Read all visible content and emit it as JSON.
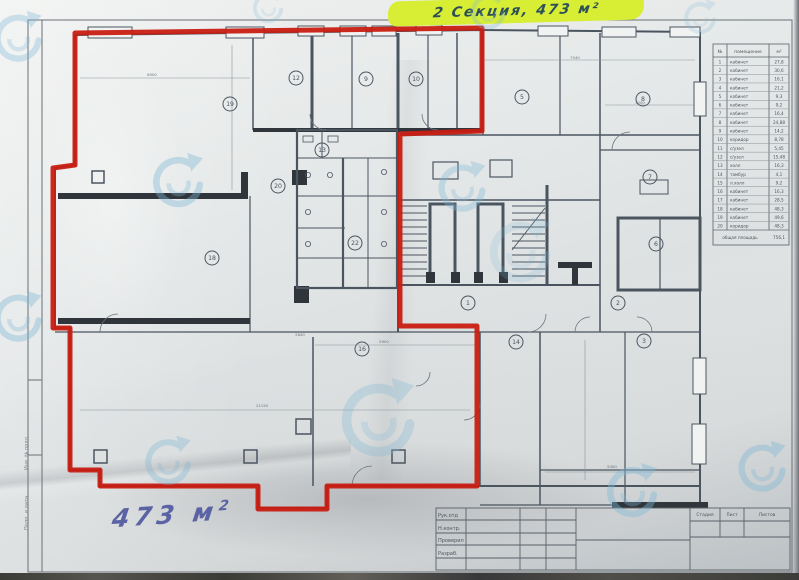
{
  "notes": {
    "top": {
      "text": "2 Секция, 473 м²"
    },
    "bottom": {
      "text": "473 м",
      "sup": "2"
    }
  },
  "colors": {
    "marker_red": "#c81d12",
    "highlight_green": "#d7ee35",
    "top_ink": "#2d4f58",
    "bottom_ink": "#5b63a4",
    "plan_line": "#4b5560",
    "watermark_blue": "#7fb8d6"
  },
  "schedule": {
    "headers": [
      "№",
      "помещение",
      "м²"
    ],
    "rows": [
      {
        "n": "1",
        "name": "кабинет",
        "area": "27,8"
      },
      {
        "n": "2",
        "name": "кабинет",
        "area": "30,6"
      },
      {
        "n": "3",
        "name": "кабинет",
        "area": "16,1"
      },
      {
        "n": "4",
        "name": "кабинет",
        "area": "21,2"
      },
      {
        "n": "5",
        "name": "кабинет",
        "area": "9,3"
      },
      {
        "n": "6",
        "name": "кабинет",
        "area": "9,2"
      },
      {
        "n": "7",
        "name": "кабинет",
        "area": "16,4"
      },
      {
        "n": "8",
        "name": "кабинет",
        "area": "24,88"
      },
      {
        "n": "9",
        "name": "кабинет",
        "area": "14,2"
      },
      {
        "n": "10",
        "name": "коридор",
        "area": "8,78"
      },
      {
        "n": "11",
        "name": "с/узел",
        "area": "5,45"
      },
      {
        "n": "12",
        "name": "с/узел",
        "area": "15,48"
      },
      {
        "n": "13",
        "name": "холл",
        "area": "16,3"
      },
      {
        "n": "14",
        "name": "тамбур",
        "area": "4,1"
      },
      {
        "n": "15",
        "name": "л.холл",
        "area": "9,2"
      },
      {
        "n": "16",
        "name": "кабинет",
        "area": "16,3"
      },
      {
        "n": "17",
        "name": "кабинет",
        "area": "28,5"
      },
      {
        "n": "18",
        "name": "кабинет",
        "area": "48,3"
      },
      {
        "n": "19",
        "name": "кабинет",
        "area": "49,6"
      },
      {
        "n": "20",
        "name": "коридор",
        "area": "48,3"
      }
    ],
    "total_label": "общая площадь",
    "total_value": "756,1"
  },
  "title_block": {
    "row_labels": [
      "Рук.отд",
      "Н.контр.",
      "Проверил",
      "Разраб."
    ],
    "stage_headers": [
      "Стадия",
      "Лист",
      "Листов"
    ]
  },
  "margin_labels": [
    "Подп. и дата",
    "Инв. № подл."
  ],
  "plan": {
    "room_numbers": [
      {
        "n": "19",
        "x": 230,
        "y": 104
      },
      {
        "n": "12",
        "x": 296,
        "y": 78
      },
      {
        "n": "9",
        "x": 366,
        "y": 79
      },
      {
        "n": "10",
        "x": 416,
        "y": 79
      },
      {
        "n": "5",
        "x": 522,
        "y": 97
      },
      {
        "n": "8",
        "x": 643,
        "y": 99
      },
      {
        "n": "20",
        "x": 278,
        "y": 186
      },
      {
        "n": "13",
        "x": 322,
        "y": 150
      },
      {
        "n": "18",
        "x": 212,
        "y": 258
      },
      {
        "n": "22",
        "x": 355,
        "y": 243
      },
      {
        "n": "7",
        "x": 650,
        "y": 177
      },
      {
        "n": "6",
        "x": 656,
        "y": 244
      },
      {
        "n": "1",
        "x": 468,
        "y": 303
      },
      {
        "n": "2",
        "x": 618,
        "y": 303
      },
      {
        "n": "16",
        "x": 362,
        "y": 349
      },
      {
        "n": "14",
        "x": 516,
        "y": 342
      },
      {
        "n": "3",
        "x": 644,
        "y": 341
      }
    ],
    "dims": [
      {
        "t": "6000",
        "x": 152,
        "y": 76
      },
      {
        "t": "7540",
        "x": 575,
        "y": 59
      },
      {
        "t": "3200",
        "x": 640,
        "y": 104
      },
      {
        "t": "21150",
        "x": 262,
        "y": 407
      },
      {
        "t": "5900",
        "x": 384,
        "y": 343
      },
      {
        "t": "5400",
        "x": 612,
        "y": 468
      },
      {
        "t": "2640",
        "x": 300,
        "y": 336
      }
    ]
  },
  "red_region": {
    "points": "75,33 482,28 482,131 400,134 400,326 477,326 477,486 327,486 327,509 258,509 258,486 100,486 100,470 70,470 70,328 53,328 53,168 75,165 75,33"
  },
  "watermarks": [
    {
      "x": -13,
      "y": 7,
      "s": 62,
      "o": 0.35
    },
    {
      "x": 145,
      "y": 149,
      "s": 66,
      "o": 0.4
    },
    {
      "x": -13,
      "y": 287,
      "s": 62,
      "o": 0.4
    },
    {
      "x": 138,
      "y": 432,
      "s": 60,
      "o": 0.35
    },
    {
      "x": 330,
      "y": 372,
      "s": 96,
      "o": 0.3
    },
    {
      "x": 431,
      "y": 157,
      "s": 62,
      "o": 0.35
    },
    {
      "x": 480,
      "y": 212,
      "s": 80,
      "o": 0.2
    },
    {
      "x": 465,
      "y": -11,
      "s": 46,
      "o": 0.28
    },
    {
      "x": 248,
      "y": -12,
      "s": 40,
      "o": 0.22
    },
    {
      "x": 599,
      "y": 459,
      "s": 66,
      "o": 0.4
    },
    {
      "x": 731,
      "y": 437,
      "s": 62,
      "o": 0.4
    },
    {
      "x": 679,
      "y": -3,
      "s": 42,
      "o": 0.22
    }
  ]
}
